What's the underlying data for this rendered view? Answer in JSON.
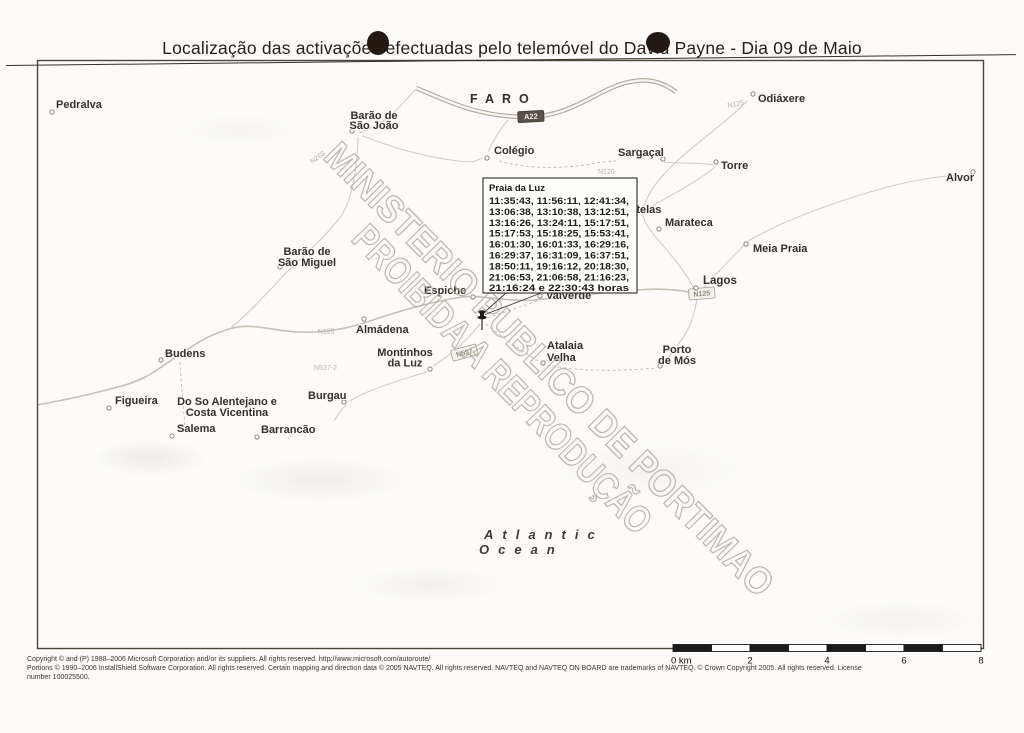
{
  "title": "Localização das activações efectuadas pelo telemóvel do David Payne - Dia 09 de Maio",
  "watermark": {
    "line1": "MINISTERIO PUBLICO DE PORTIMAO",
    "line2": "PROIBIDA A REPRODUÇÃO"
  },
  "ocean": {
    "line1": "Atlantic",
    "line2": "Ocean"
  },
  "callout": {
    "title": "Praia da Luz",
    "lines": [
      "11:35:43, 11:56:11, 12:41:34,",
      "13:06:38, 13:10:38, 13:12:51,",
      "13:16:26, 13:24:11, 15:17:51,",
      "15:17:53, 15:18:25, 15:53:41,",
      "16:01:30, 16:01:33, 16:29:16,",
      "16:29:37, 16:31:09, 16:37:51,",
      "18:50:11, 19:16:12, 20:18:30,",
      "21:06:53, 21:06:58, 21:16:23,",
      "21:16:24 e 22:30:43 horas"
    ]
  },
  "map": {
    "roads": [
      {
        "type": "motorway",
        "d": "M 416,88 C 446,100 476,117 527,117 C 572,117 597,89 629,82 C 649,78 663,82 676,92"
      },
      {
        "type": "major",
        "d": "M 37,405 C 70,399 96,393 118,387 C 146,380 158,369 176,357 C 194,345 206,336 229,329 C 253,322 271,331 299,332 C 323,333 346,329 367,322 C 393,313 426,303 456,298 C 473,295 481,297 491,298 C 509,300 523,301 535,300"
      },
      {
        "type": "major",
        "d": "M 535,300 C 566,297 606,292 636,290 C 661,288 681,290 695,293"
      },
      {
        "type": "minor",
        "d": "M 231,328 C 253,309 269,291 285,274 C 301,258 323,239 339,219 C 353,201 357,166 358,137"
      },
      {
        "type": "minor",
        "d": "M 359,133 C 376,127 391,117 401,105 C 409,97 411,94 416,89"
      },
      {
        "type": "minor",
        "d": "M 363,136 C 396,149 431,159 469,162 C 475,162 478,160 482,158"
      },
      {
        "type": "minor",
        "d": "M 488,152 C 493,141 499,130 508,120"
      },
      {
        "type": "dashed",
        "d": "M 499,161 C 528,169 561,169 591,164 C 601,162 610,161 616,161"
      },
      {
        "type": "minor",
        "d": "M 664,162 C 682,164 701,162 713,165"
      },
      {
        "type": "minor",
        "d": "M 715,167 C 699,181 669,196 649,208"
      },
      {
        "type": "minor",
        "d": "M 747,101 C 734,116 699,141 677,161 C 659,178 649,191 644,206 C 639,219 651,231 659,241 C 671,255 687,273 695,291"
      },
      {
        "type": "minor",
        "d": "M 699,293 C 711,279 727,263 745,244"
      },
      {
        "type": "minor",
        "d": "M 747,242 C 780,221 850,196 900,184 C 925,178 950,175 970,175"
      },
      {
        "type": "minor",
        "d": "M 697,297 C 695,316 689,331 677,346 C 671,354 666,361 661,367"
      },
      {
        "type": "dashed",
        "d": "M 537,301 C 521,307 501,313 487,318"
      },
      {
        "type": "dashed",
        "d": "M 486,324 C 503,338 523,352 540,362"
      },
      {
        "type": "dashed",
        "d": "M 547,365 C 581,372 621,371 657,368"
      },
      {
        "type": "minor",
        "d": "M 480,324 C 467,340 451,355 433,366"
      },
      {
        "type": "minor",
        "d": "M 427,372 C 399,380 367,390 350,401"
      },
      {
        "type": "minor",
        "d": "M 346,405 C 340,411 337,416 334,421"
      },
      {
        "type": "dashed",
        "d": "M 180,362 C 181,382 183,402 185,426"
      }
    ],
    "road_labels": [
      {
        "style": "plain",
        "text": "N268",
        "x": 312,
        "y": 164,
        "rotate": -35
      },
      {
        "style": "plain",
        "text": "N125",
        "x": 728,
        "y": 108,
        "rotate": -12
      },
      {
        "style": "plain",
        "text": "N120",
        "x": 598,
        "y": 174,
        "rotate": 0
      },
      {
        "style": "plain",
        "text": "N125",
        "x": 318,
        "y": 334,
        "rotate": -3
      },
      {
        "style": "plain",
        "text": "N537-2",
        "x": 314,
        "y": 370,
        "rotate": 0
      },
      {
        "style": "shield-dark",
        "text": "A22",
        "x": 531,
        "y": 119,
        "rotate": -3
      },
      {
        "style": "shield-light",
        "text": "N125",
        "x": 702,
        "y": 296,
        "rotate": -5
      },
      {
        "style": "shield-light",
        "text": "N537",
        "x": 465,
        "y": 355,
        "rotate": -15
      }
    ],
    "places": [
      {
        "lines": [
          "Pedralva"
        ],
        "x": 56,
        "y": 108,
        "anchor": "start",
        "marker": [
          52,
          112
        ]
      },
      {
        "lines": [
          "Barão de",
          "São João"
        ],
        "x": 374,
        "y": 119,
        "lh": 10,
        "anchor": "middle",
        "marker": [
          352,
          131
        ]
      },
      {
        "lines": [
          "FARO"
        ],
        "x": 470,
        "y": 103,
        "anchor": "start",
        "fs": 12.5,
        "ls": 8
      },
      {
        "lines": [
          "Odiáxere"
        ],
        "x": 758,
        "y": 102,
        "anchor": "start",
        "marker": [
          753,
          94
        ]
      },
      {
        "lines": [
          "Colégio"
        ],
        "x": 494,
        "y": 154,
        "anchor": "start",
        "marker": [
          487,
          158
        ]
      },
      {
        "lines": [
          "Sargaçal"
        ],
        "x": 618,
        "y": 156,
        "anchor": "start",
        "marker": [
          663,
          159
        ]
      },
      {
        "lines": [
          "Torre"
        ],
        "x": 721,
        "y": 169,
        "anchor": "start",
        "marker": [
          716,
          162
        ]
      },
      {
        "lines": [
          "Alvor"
        ],
        "x": 946,
        "y": 181,
        "anchor": "start",
        "marker": [
          973,
          172
        ]
      },
      {
        "lines": [
          "Portelas"
        ],
        "x": 618,
        "y": 213,
        "anchor": "start"
      },
      {
        "lines": [
          "Marateca"
        ],
        "x": 665,
        "y": 226,
        "anchor": "start",
        "marker": [
          659,
          229
        ]
      },
      {
        "lines": [
          "Meia Praia"
        ],
        "x": 753,
        "y": 252,
        "anchor": "start",
        "marker": [
          746,
          244
        ]
      },
      {
        "lines": [
          "Lagos"
        ],
        "x": 703,
        "y": 284,
        "anchor": "start",
        "fs": 11.5,
        "marker": [
          696,
          288
        ]
      },
      {
        "lines": [
          "Barão de",
          "São Miguel"
        ],
        "x": 307,
        "y": 255,
        "lh": 11,
        "anchor": "middle",
        "marker": [
          280,
          267
        ]
      },
      {
        "lines": [
          "Espiche"
        ],
        "x": 424,
        "y": 294,
        "anchor": "start",
        "marker": [
          473,
          297
        ]
      },
      {
        "lines": [
          "Valverde"
        ],
        "x": 546,
        "y": 299,
        "anchor": "start",
        "marker": [
          540,
          296
        ]
      },
      {
        "lines": [
          "Almádena"
        ],
        "x": 356,
        "y": 333,
        "anchor": "start",
        "marker": [
          364,
          319
        ]
      },
      {
        "lines": [
          "Budens"
        ],
        "x": 165,
        "y": 357,
        "anchor": "start",
        "marker": [
          161,
          360
        ]
      },
      {
        "lines": [
          "Montinhos",
          "da Luz"
        ],
        "x": 405,
        "y": 356,
        "lh": 10.5,
        "anchor": "middle",
        "marker": [
          430,
          369
        ]
      },
      {
        "lines": [
          "Atalaia",
          "Velha"
        ],
        "x": 547,
        "y": 349,
        "lh": 12,
        "anchor": "start",
        "marker": [
          543,
          363
        ]
      },
      {
        "lines": [
          "Porto",
          "de Mós"
        ],
        "x": 677,
        "y": 353,
        "lh": 11,
        "anchor": "middle",
        "marker": [
          660,
          366
        ]
      },
      {
        "lines": [
          "Figueira"
        ],
        "x": 115,
        "y": 404,
        "anchor": "start",
        "marker": [
          109,
          408
        ]
      },
      {
        "lines": [
          "Do So Alentejano e",
          "Costa Vicentina"
        ],
        "x": 227,
        "y": 405,
        "lh": 11,
        "anchor": "middle"
      },
      {
        "lines": [
          "Burgau"
        ],
        "x": 308,
        "y": 399,
        "anchor": "start",
        "marker": [
          344,
          402
        ]
      },
      {
        "lines": [
          "Salema"
        ],
        "x": 177,
        "y": 432,
        "anchor": "start",
        "marker": [
          172,
          436
        ]
      },
      {
        "lines": [
          "Barrancão"
        ],
        "x": 261,
        "y": 433,
        "anchor": "start",
        "marker": [
          257,
          437
        ]
      }
    ]
  },
  "scale_bar": {
    "labels": [
      "0 km",
      "2",
      "4",
      "6",
      "8"
    ]
  },
  "footer": {
    "line1": "Copyright © and (P) 1988–2006 Microsoft Corporation and/or its suppliers. All rights reserved. http://www.microsoft.com/autoroute/",
    "line2": "Portions © 1990–2006 InstallShield Software Corporation. All rights reserved. Certain mapping and direction data © 2005 NAVTEQ. All rights reserved. NAVTEQ and NAVTEQ ON BOARD are trademarks of NAVTEQ. © Crown Copyright 2005. All rights reserved. License",
    "line3": "number 100025500."
  },
  "colors": {
    "ink": "#35302b",
    "faint_label": "#b8b1a9",
    "shield_dark_bg": "#57504b",
    "watermark": "#b4aba2",
    "scale_black": "#1a1a1a",
    "map_border": "#4d443c"
  }
}
